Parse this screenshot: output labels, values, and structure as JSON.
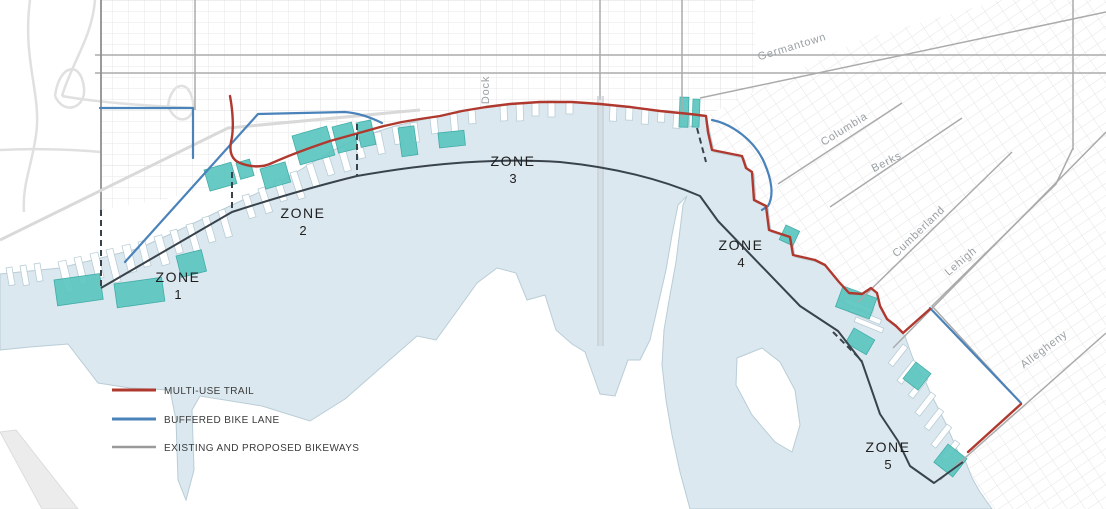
{
  "map": {
    "title": "Waterfront trail zone plan",
    "zones": [
      {
        "label": "ZONE",
        "number": "1"
      },
      {
        "label": "ZONE",
        "number": "2"
      },
      {
        "label": "ZONE",
        "number": "3"
      },
      {
        "label": "ZONE",
        "number": "4"
      },
      {
        "label": "ZONE",
        "number": "5"
      }
    ],
    "streets": {
      "dock": "Dock",
      "germantown": "Germantown",
      "columbia": "Columbia",
      "berks": "Berks",
      "cumberland": "Cumberland",
      "lehigh": "Lehigh",
      "allegheny": "Allegheny"
    }
  },
  "legend": {
    "items": [
      {
        "label": "MULTI-USE TRAIL",
        "color": "#b0392f"
      },
      {
        "label": "BUFFERED BIKE LANE",
        "color": "#4a82ba"
      },
      {
        "label": "EXISTING AND PROPOSED BIKEWAYS",
        "color": "#9a9a9a"
      }
    ]
  },
  "colors": {
    "water": "#dbe8ef",
    "shoreline": "#b9cdd6",
    "highlighted_piers": "#5cc6c0",
    "zone_boundary": "#39434b",
    "multi_use_trail": "#b0392f",
    "buffered_bike_lane": "#4a82ba",
    "existing_bikeways": "#9a9a9a"
  }
}
